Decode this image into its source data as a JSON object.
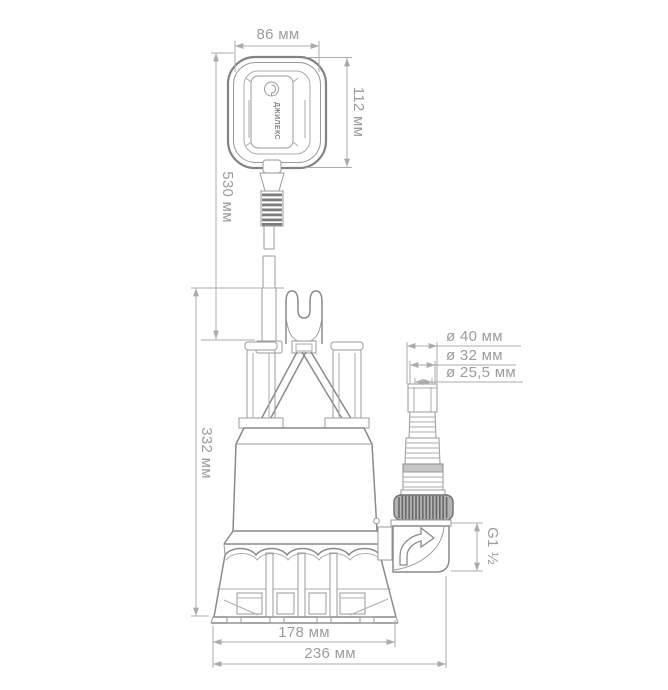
{
  "page": {
    "background_color": "#ffffff"
  },
  "drawing": {
    "units": "мм",
    "colors": {
      "outline": "#8a8a8a",
      "dimension_lines": "#ababab",
      "dimension_text": "#9c9c9c",
      "dark_detail": "#7d7d7d",
      "nut_fill": "#b3b3b3",
      "step_band_fill": "#c6c6c6"
    },
    "float_switch": {
      "brand_label": "ДЖИЛЕКС"
    },
    "dimensions": {
      "float_width": "86 мм",
      "float_height": "112 мм",
      "cable_length": "530 мм",
      "pump_height": "332 мм",
      "hose_step_40": "ø 40 мм",
      "hose_step_32": "ø 32 мм",
      "hose_step_25_5": "ø 25,5 мм",
      "outlet_thread": "G1 ½",
      "base_width": "178 мм",
      "overall_width": "236 мм"
    }
  }
}
